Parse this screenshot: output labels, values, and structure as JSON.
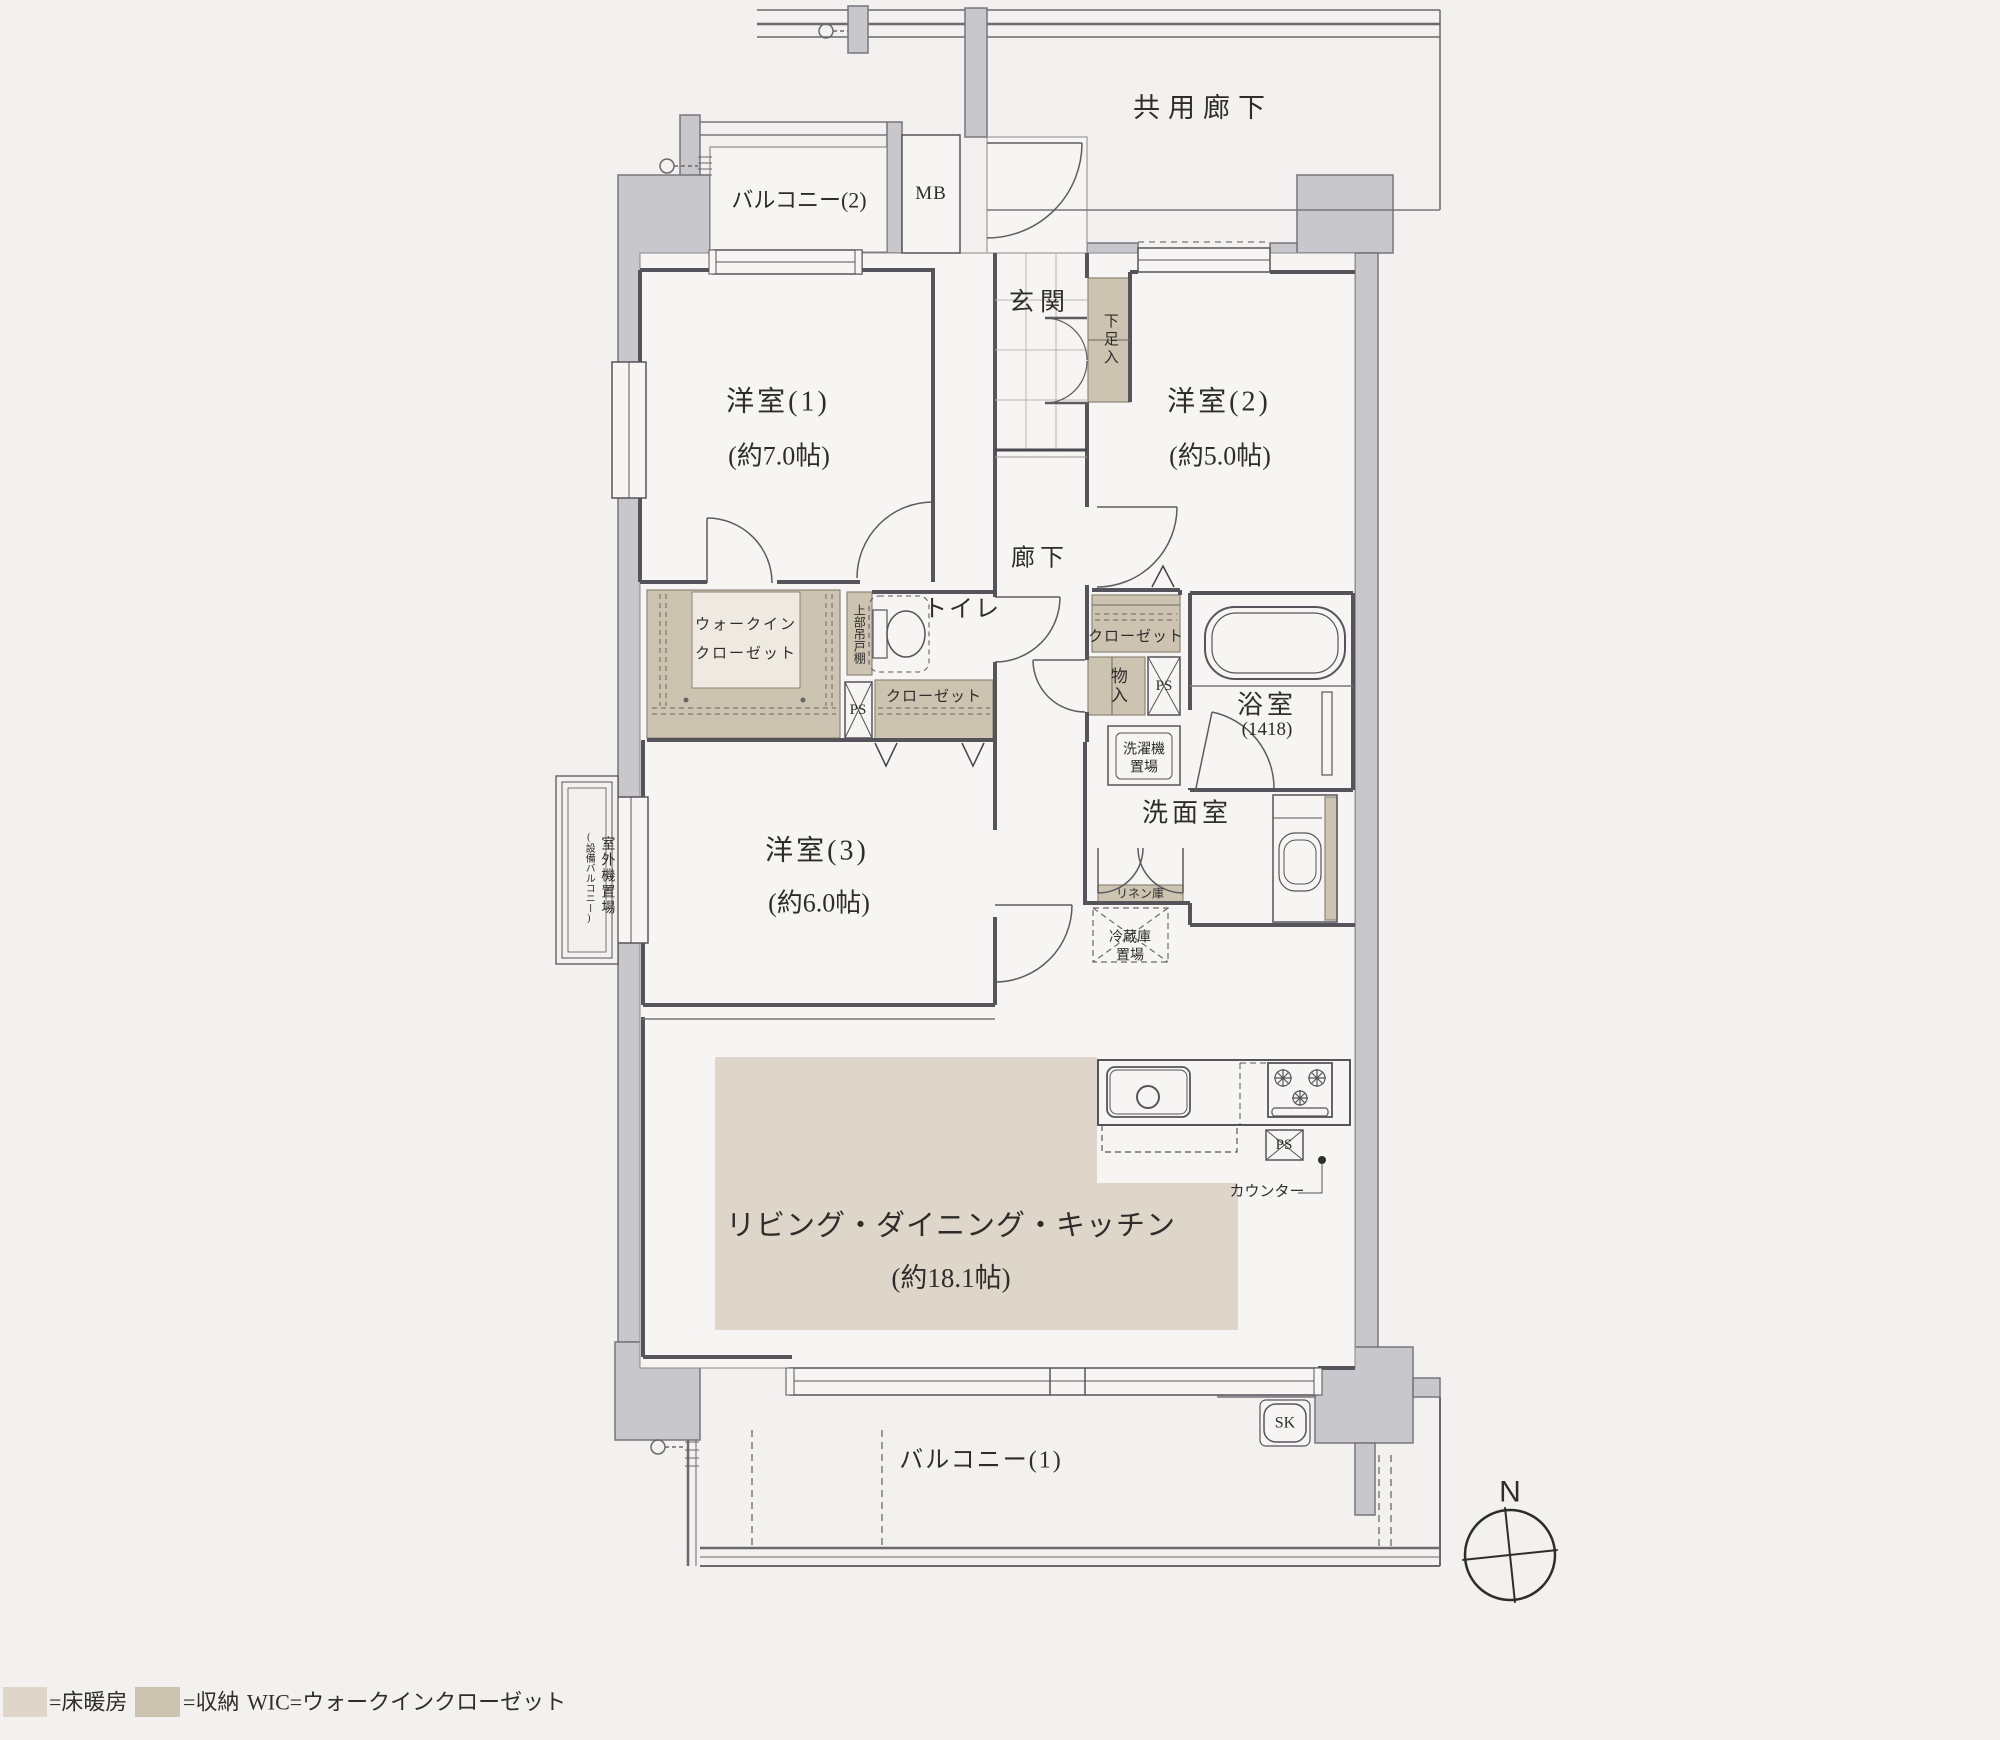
{
  "plan": {
    "common_corridor": "共用廊下",
    "balcony2": "バルコニー(2)",
    "mb": "MB",
    "entrance": "玄関",
    "shoe_cabinet": "下足入",
    "room1": "洋室(1)",
    "room1_size": "(約7.0帖)",
    "room2": "洋室(2)",
    "room2_size": "(約5.0帖)",
    "hallway": "廊下",
    "toilet": "トイレ",
    "wic_line1": "ウォークイン",
    "wic_line2": "クローゼット",
    "upper_cabinet": "上部吊戸棚",
    "ps": "PS",
    "closet": "クローゼット",
    "storage_small": "物入",
    "bath": "浴室",
    "bath_size": "(1418)",
    "washer_line1": "洗濯機",
    "washer_line2": "置場",
    "washroom": "洗面室",
    "linen": "リネン庫",
    "fridge_line1": "冷蔵庫",
    "fridge_line2": "置場",
    "room3": "洋室(3)",
    "room3_size": "(約6.0帖)",
    "ldk": "リビング・ダイニング・キッチン",
    "ldk_size": "(約18.1帖)",
    "counter": "カウンター",
    "balcony1": "バルコニー(1)",
    "sk": "SK",
    "outdoor_unit": "室外機置場",
    "outdoor_unit_sub": "(設備バルコニー)"
  },
  "compass": {
    "north": "N"
  },
  "legend": {
    "floor_heating": "=床暖房",
    "storage": "=収納",
    "wic": "WIC=ウォークインクローゼット"
  },
  "colors": {
    "background": "#f2f1ef",
    "wall": "#c8c7cb",
    "floor_heating": "#ded7c9",
    "storage": "#cdc3b1",
    "line": "#55545a"
  }
}
